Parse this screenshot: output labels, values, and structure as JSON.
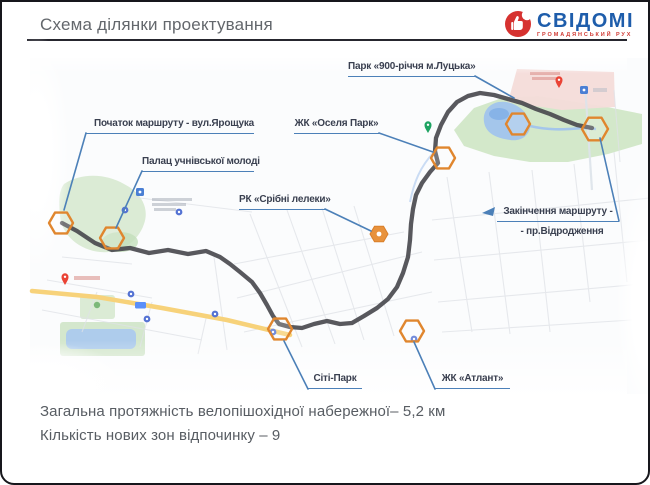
{
  "header": {
    "title": "Схема ділянки проектування",
    "logo_text": "СВІДОМІ",
    "logo_subtext": "ГРОМАДЯНСЬКИЙ РУХ"
  },
  "map": {
    "labels": [
      {
        "id": "route-start",
        "text": "Початок маршруту - вул.Ярощука"
      },
      {
        "id": "youth-palace",
        "text": "Палац учнівської молоді"
      },
      {
        "id": "oselia-park",
        "text": "ЖК «Оселя Парк»"
      },
      {
        "id": "park-900",
        "text": "Парк «900-річчя м.Луцька»"
      },
      {
        "id": "sribni-leleky",
        "text": "РК «Срібні лелеки»"
      },
      {
        "id": "route-end",
        "text": "Закінчення маршруту -",
        "text2": "- пр.Відродження"
      },
      {
        "id": "city-park",
        "text": "Сіті-Парк"
      },
      {
        "id": "atlant",
        "text": "ЖК «Атлант»"
      }
    ],
    "marker_count": 9
  },
  "footer": {
    "line1": "Загальна протяжність велопішохідної набережної– 5,2 км",
    "line2": "Кількість нових зон відпочинку – 9"
  },
  "colors": {
    "marker_orange": "#e0862e",
    "route_gray": "#4a4a4f",
    "callout_blue": "#4c80b8",
    "logo_red": "#d63230",
    "logo_blue": "#1e5dab",
    "park_green": "#cfe6c6",
    "water_blue": "#9ec2ee",
    "road_yellow": "#f7d27a"
  }
}
